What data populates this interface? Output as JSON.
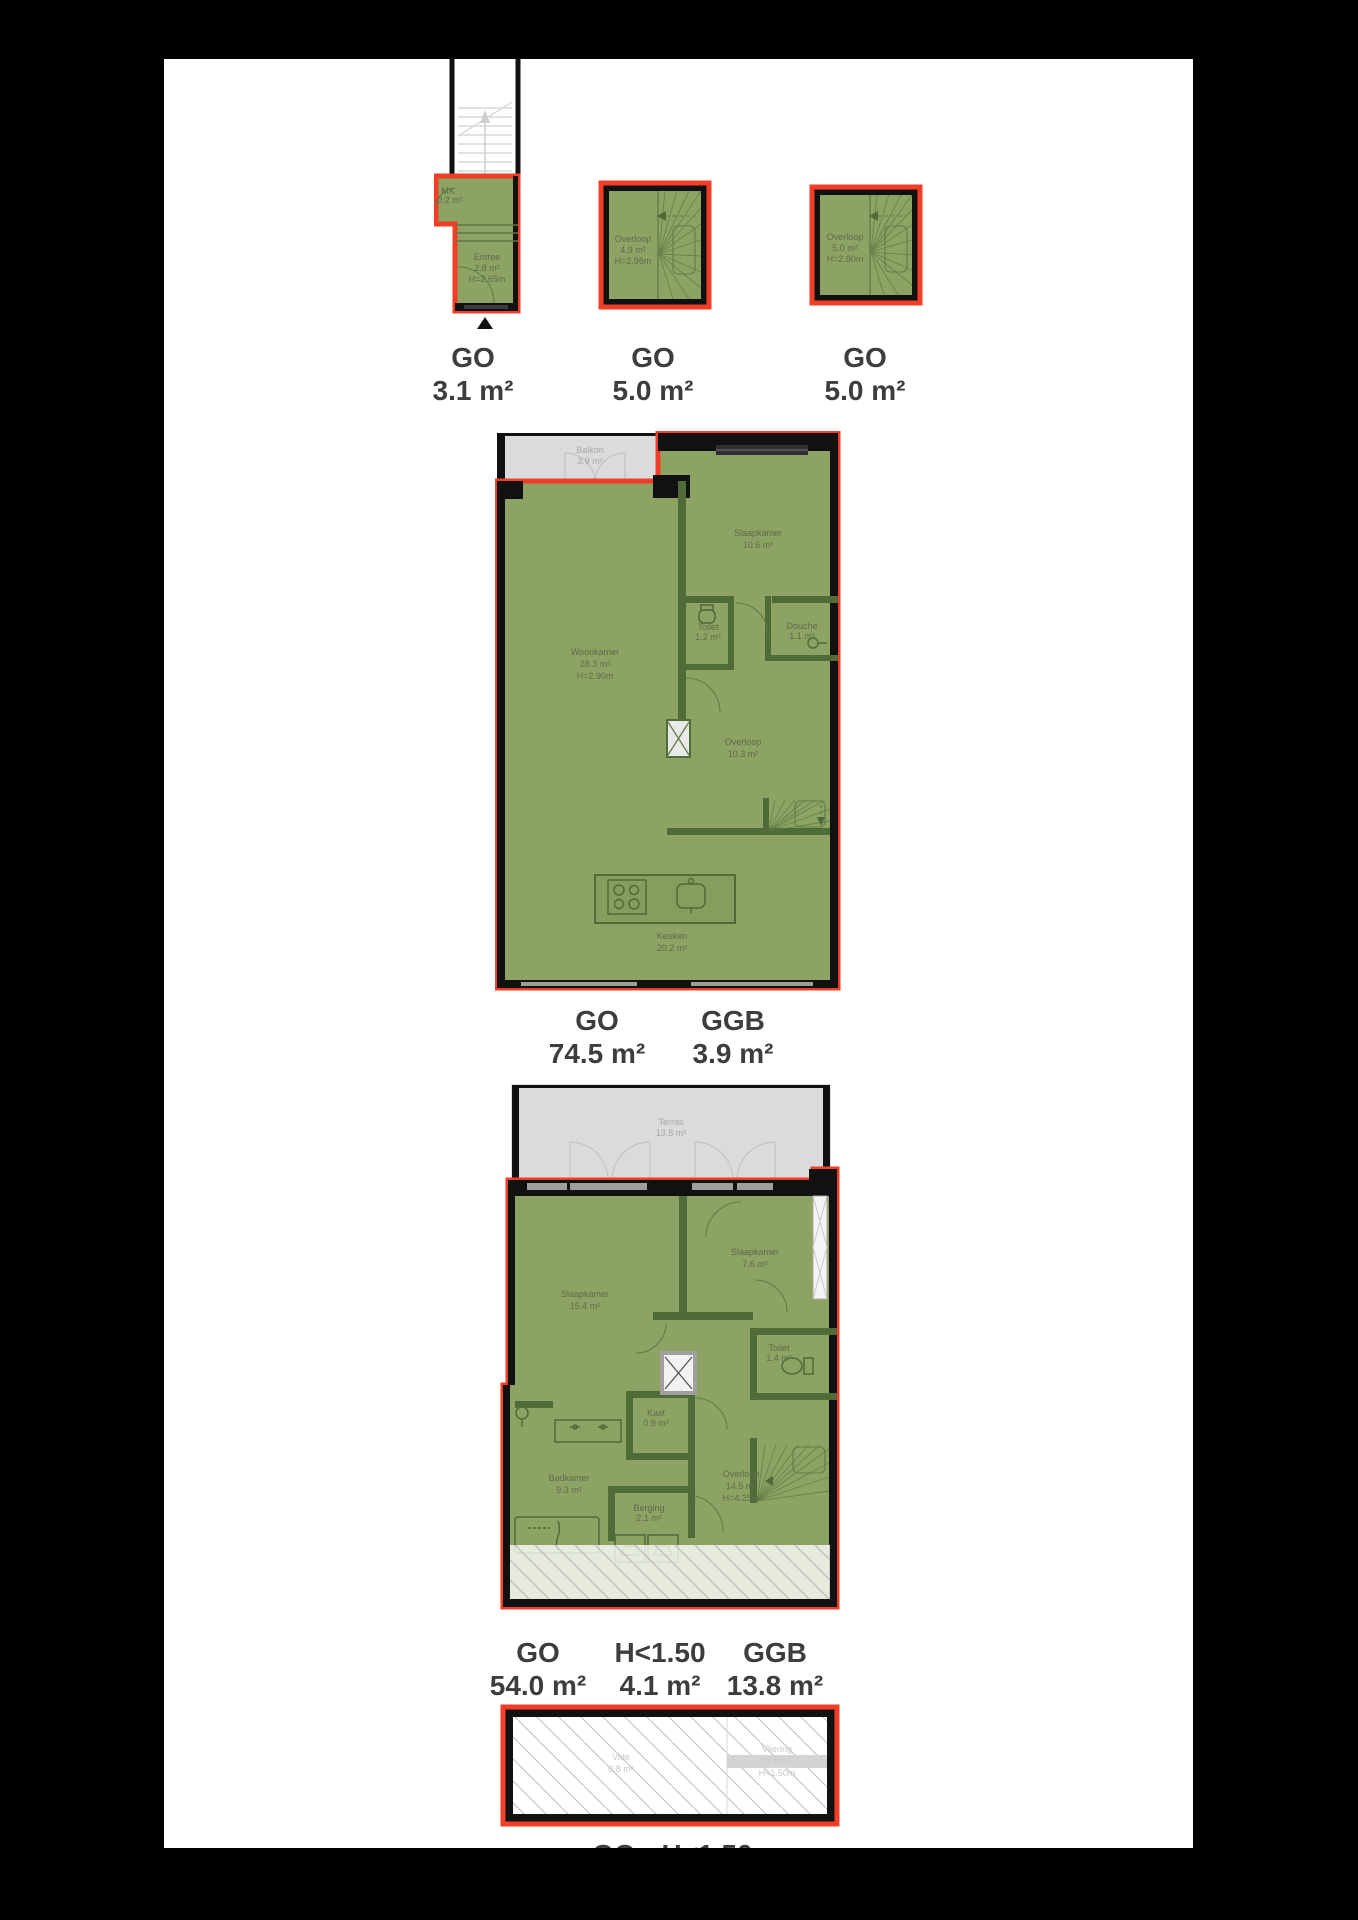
{
  "document_type": "floorplan-sheet",
  "colors": {
    "go_fill": "#8CA363",
    "interior_wall": "#4F6B37",
    "outline_red": "#F23E27",
    "wall_black": "#111111",
    "outdoor_gray": "#DBDBDB",
    "label_text": "#3d3d3d",
    "room_text": "#5E6C4B",
    "faint_text": "#c9c9c9"
  },
  "floors": [
    {
      "id": "begane-grond",
      "rooms": [
        {
          "name": "MK",
          "area": "0.2 m²"
        },
        {
          "name": "Entree",
          "area": "2.8 m²",
          "height": "H=2.65m"
        }
      ],
      "labels": [
        {
          "title": "GO",
          "value": "3.1 m²"
        }
      ]
    },
    {
      "id": "verdieping-1",
      "rooms": [
        {
          "name": "Overloop",
          "area": "4.9 m²",
          "height": "H=2.96m"
        }
      ],
      "labels": [
        {
          "title": "GO",
          "value": "5.0 m²"
        }
      ]
    },
    {
      "id": "verdieping-2",
      "rooms": [
        {
          "name": "Overloop",
          "area": "5.0 m²",
          "height": "H=2.80m"
        }
      ],
      "labels": [
        {
          "title": "GO",
          "value": "5.0 m²"
        }
      ]
    },
    {
      "id": "woonverdieping",
      "rooms": [
        {
          "name": "Balkon",
          "area": "3.9 m²"
        },
        {
          "name": "Slaapkamer",
          "area": "10.6 m²"
        },
        {
          "name": "Woonkamer",
          "area": "28.3 m²",
          "height": "H=2.90m"
        },
        {
          "name": "Toilet",
          "area": "1.2 m²"
        },
        {
          "name": "Douche",
          "area": "1.1 m²"
        },
        {
          "name": "Overloop",
          "area": "10.3 m²"
        },
        {
          "name": "Keuken",
          "area": "20.2 m²"
        }
      ],
      "labels": [
        {
          "title": "GO",
          "value": "74.5 m²"
        },
        {
          "title": "GGB",
          "value": "3.9 m²"
        }
      ]
    },
    {
      "id": "slaapverdieping",
      "rooms": [
        {
          "name": "Terras",
          "area": "13.8 m²"
        },
        {
          "name": "Slaapkamer",
          "area": "15.4 m²"
        },
        {
          "name": "Slaapkamer",
          "area": "7.6 m²"
        },
        {
          "name": "Toilet",
          "area": "1.4 m²"
        },
        {
          "name": "Kast",
          "area": "0.9 m²"
        },
        {
          "name": "Badkamer",
          "area": "9.3 m²"
        },
        {
          "name": "Overloop",
          "area": "14.5 m²",
          "height": "H=4.25m"
        },
        {
          "name": "Berging",
          "area": "2.1 m²"
        }
      ],
      "labels": [
        {
          "title": "GO",
          "value": "54.0 m²"
        },
        {
          "title": "H<1.50",
          "value": "4.1 m²"
        },
        {
          "title": "GGB",
          "value": "13.8 m²"
        }
      ]
    },
    {
      "id": "vliering",
      "rooms": [
        {
          "name": "Vide",
          "area": "0.8 m²"
        },
        {
          "name": "Vliering",
          "area": "0.4 m²",
          "height": "H<1.50m"
        }
      ],
      "labels": [
        {
          "title": "GO"
        },
        {
          "title": "H<1.50"
        }
      ]
    }
  ]
}
